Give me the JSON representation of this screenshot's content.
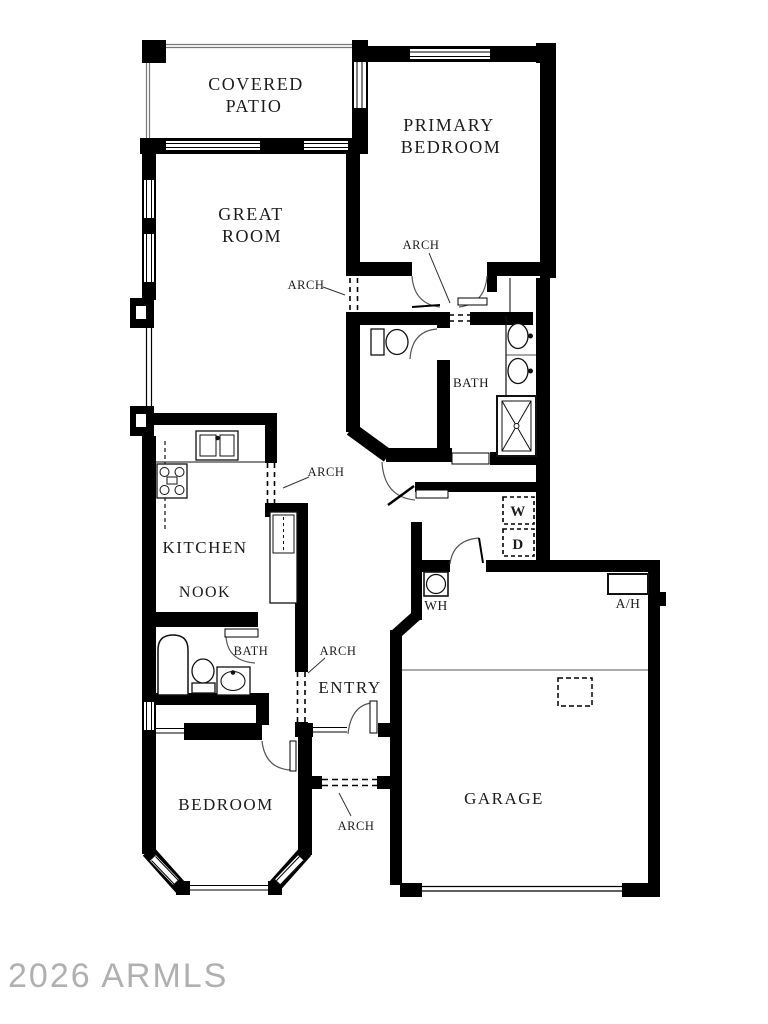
{
  "watermark": "2026 ARMLS",
  "rooms": {
    "covered_patio_line1": "COVERED",
    "covered_patio_line2": "PATIO",
    "primary_bedroom_line1": "PRIMARY",
    "primary_bedroom_line2": "BEDROOM",
    "great_room_line1": "GREAT",
    "great_room_line2": "ROOM",
    "kitchen": "KITCHEN",
    "nook": "NOOK",
    "primary_bath": "BATH",
    "hall_bath": "BATH",
    "entry": "ENTRY",
    "bedroom": "BEDROOM",
    "garage": "GARAGE"
  },
  "labels": {
    "arch": "ARCH",
    "washer": "W",
    "dryer": "D",
    "water_heater": "WH",
    "air_handler": "A/H"
  },
  "colors": {
    "wall": "#000000",
    "thin_line": "#555555",
    "watermark": "#b0b0b0",
    "background": "#ffffff"
  }
}
